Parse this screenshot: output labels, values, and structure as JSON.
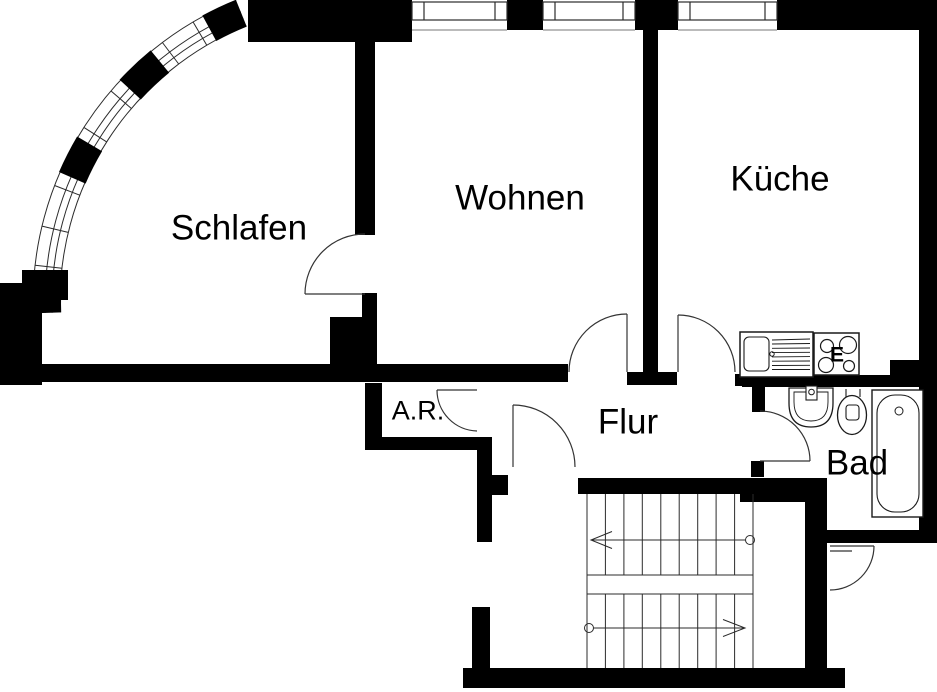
{
  "floorplan": {
    "colors": {
      "background": "#ffffff",
      "walls": "#000000",
      "thin_lines": "#2b2b2b"
    },
    "rooms": [
      {
        "id": "schlafen",
        "label": "Schlafen"
      },
      {
        "id": "wohnen",
        "label": "Wohnen"
      },
      {
        "id": "kueche",
        "label": "Küche"
      },
      {
        "id": "flur",
        "label": "Flur"
      },
      {
        "id": "bad",
        "label": "Bad"
      },
      {
        "id": "abstellraum",
        "label": "A.R."
      }
    ],
    "stove_label": "E",
    "fixtures": {
      "kitchen": [
        "kitchen-sink-with-drainboard",
        "electric-stove-4-burners"
      ],
      "bath": [
        "wash-basin",
        "toilet",
        "bathtub"
      ],
      "stairwell": [
        "staircase-two-flights",
        "up-arrow",
        "down-arrow"
      ]
    },
    "doors": [
      "schlafen-door",
      "wohnen-door",
      "kueche-door",
      "bad-door",
      "abstellraum-door",
      "entry-door",
      "neighbor-door"
    ],
    "windows": {
      "top_wall_count": 3,
      "bay_window_segments": 5
    }
  }
}
